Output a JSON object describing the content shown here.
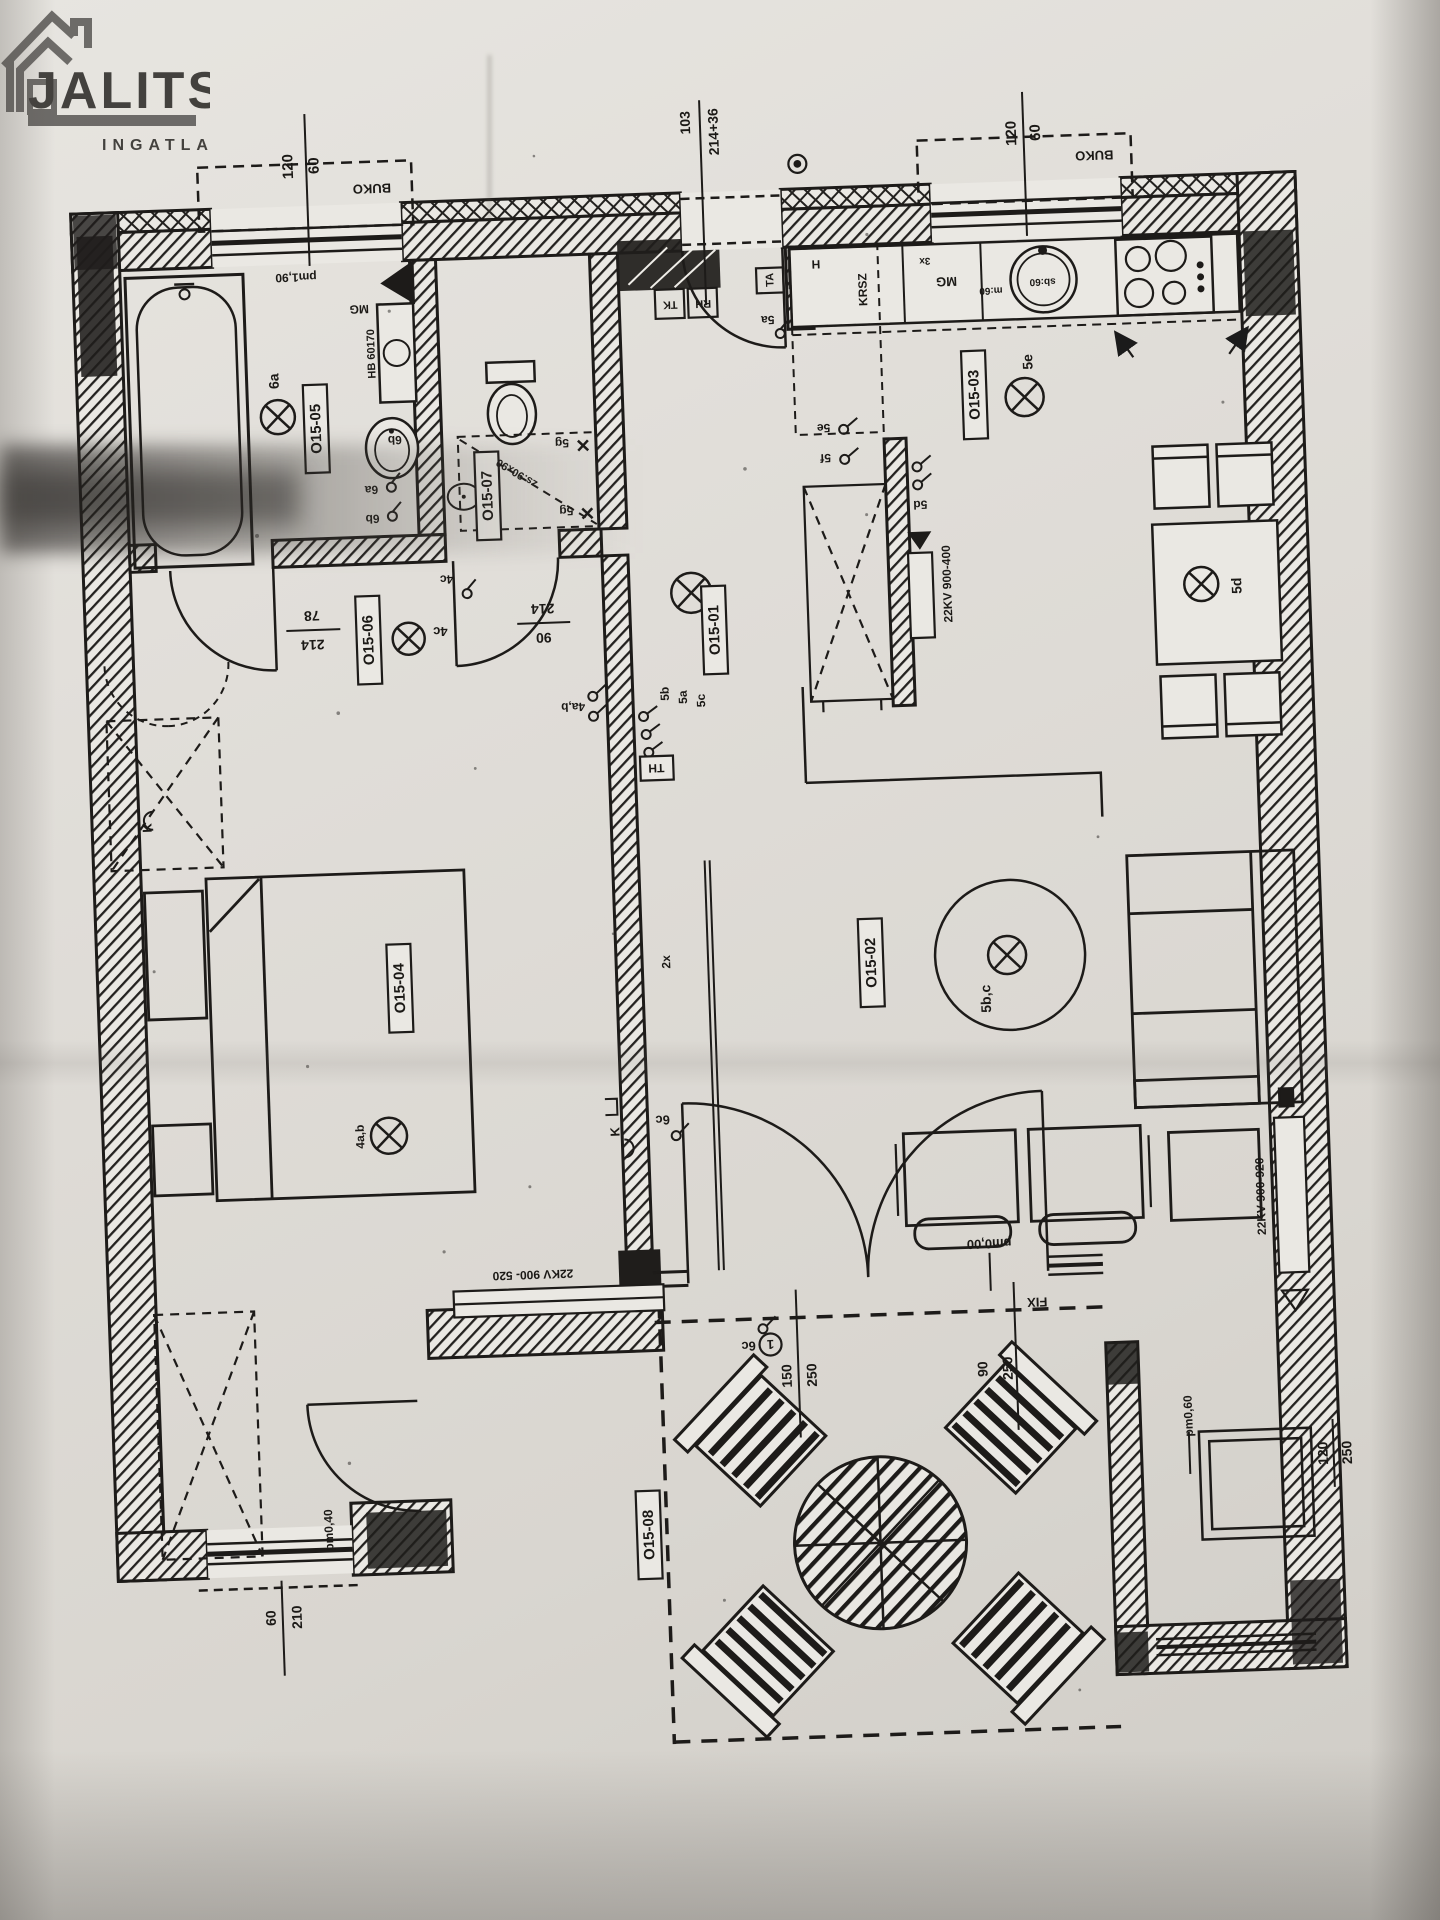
{
  "logo": {
    "title": "JALITS",
    "subtitle": "INGATLAN"
  },
  "rooms": {
    "bathroom": "O15-05",
    "wc": "O15-07",
    "vestibule": "O15-06",
    "hall": "O15-01",
    "kitchen": "O15-03",
    "bedroom": "O15-04",
    "living": "O15-02",
    "terrace": "O15-08"
  },
  "dims": {
    "v60": "60",
    "v78": "78",
    "v90": "90",
    "v103": "103",
    "v120": "120",
    "v150": "150",
    "v210": "210",
    "v214": "214",
    "v21436": "214+36",
    "v250": "250",
    "buko": "BUKO"
  },
  "levels": {
    "terrace": "pm0,00",
    "side": "pm0,40",
    "nook": "pm0,60",
    "bath": "pm1,90"
  },
  "electrical": {
    "l6a": "6a",
    "s6a": "6a",
    "s6b": "6b",
    "b6b": "6b",
    "g5_1": "5g",
    "g5_2": "5g",
    "l4c": "4c",
    "s4c": "4c",
    "s4ab": "4a,b",
    "l4ab": "4a,b",
    "s5b": "5b",
    "s5a": "5a",
    "s5c": "5c",
    "s5a2": "5a",
    "s5e": "5e",
    "s5f": "5f",
    "l5e": "5e",
    "l5d": "5d",
    "s5d": "5d",
    "l5bc": "5b,c",
    "s6c_a": "6c",
    "s6c_b": "6c",
    "th": "TH",
    "tk": "TK",
    "rh": "RH",
    "ta": "TA",
    "note1": "1",
    "x2": "2x",
    "x3": "3x",
    "k": "K"
  },
  "equipment": {
    "washer": "HB 60170",
    "mg": "MG",
    "dw": "m:60",
    "sink": "sb:60",
    "fridge_h": "H",
    "krsz": "KRSZ",
    "shower": "zs:90x90",
    "rad_kitchen": "22KV 900-400",
    "rad_living": "22KV 900-920",
    "rad_bedroom": "22KV 900- 520",
    "fix": "FIX"
  }
}
